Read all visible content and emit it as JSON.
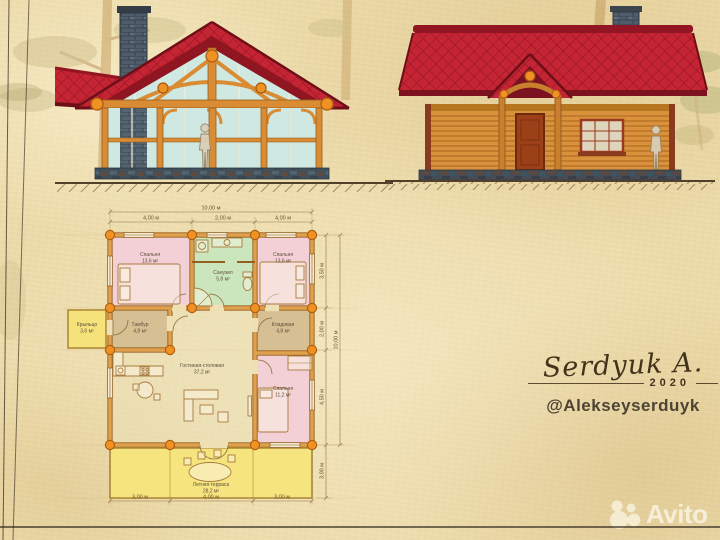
{
  "signature": {
    "name": "Serdyuk A.",
    "year": "2020",
    "handle": "@Alekseyserduyk"
  },
  "watermark": {
    "brand": "Avito"
  },
  "floor_plan": {
    "dimensions_top": {
      "total": "10,00 м",
      "segments": [
        "4,00 м",
        "2,00 м",
        "4,00 м"
      ]
    },
    "dimensions_bottom": {
      "segments": [
        "3,00 м",
        "4,00 м",
        "3,00 м"
      ]
    },
    "dimensions_right": {
      "total": "10,00 м",
      "segments": [
        "3,50 м",
        "2,00 м",
        "4,50 м",
        "3,00 м"
      ]
    },
    "rooms": [
      {
        "id": "bedroom-1",
        "name": "Спальня",
        "area": "13,6 м²"
      },
      {
        "id": "bathroom",
        "name": "Санузел",
        "area": "5,8 м²"
      },
      {
        "id": "bedroom-2",
        "name": "Спальня",
        "area": "13,6 м²"
      },
      {
        "id": "porch",
        "name": "Крыльцо",
        "area": "3,6 м²"
      },
      {
        "id": "hall",
        "name": "Тамбур",
        "area": "4,8 м²"
      },
      {
        "id": "storage",
        "name": "Кладовая",
        "area": "4,8 м²"
      },
      {
        "id": "living",
        "name": "Гостиная-столовая",
        "area": "37,2 м²"
      },
      {
        "id": "bedroom-3",
        "name": "Спальня",
        "area": "11,2 м²"
      },
      {
        "id": "terrace",
        "name": "Летняя терраса",
        "area": "28,2 м²"
      }
    ]
  },
  "colors": {
    "roof": "#c42433",
    "roof_dark": "#7c1120",
    "wood": "#d9913b",
    "wood_dark": "#a05c1a",
    "glass": "#cfe9e2",
    "stone": "#4f5d6b",
    "paper": "#ecdbaa",
    "column": "#f09123",
    "plan_pink": "#f3cfd6",
    "plan_green": "#cbe6bd",
    "plan_tan": "#d6bf92",
    "plan_yellow": "#f5e27a",
    "ink": "#5c4f3d"
  }
}
